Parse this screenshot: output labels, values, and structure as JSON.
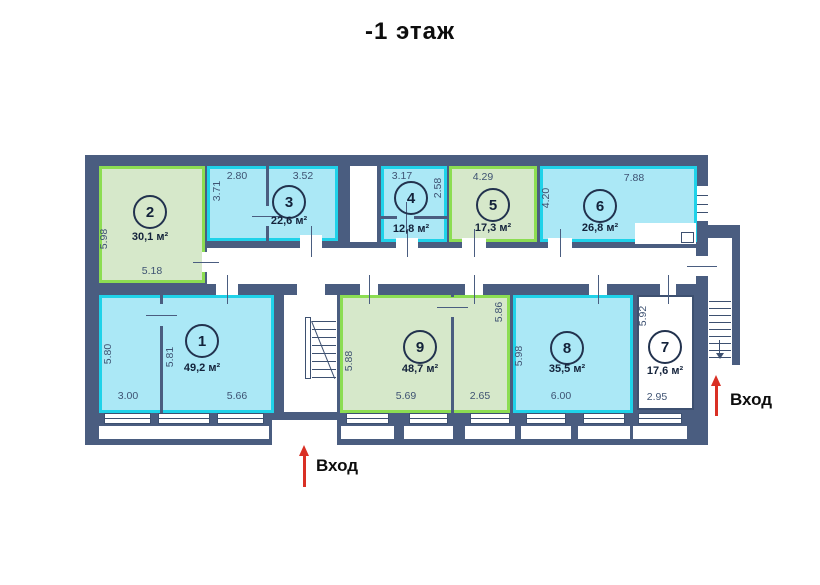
{
  "title": "-1 этаж",
  "colors": {
    "wall": "#4a5d80",
    "green_fill": "#d6e8ca",
    "green_border": "#8cdd52",
    "cyan_fill": "#abe8f6",
    "cyan_border": "#1fd2e9",
    "white_fill": "#ffffff",
    "white_border": "#3d5070",
    "dim_text": "#3e5272",
    "label_text": "#13223a",
    "arrow_red": "#d93025"
  },
  "plan": {
    "walls": [
      {
        "name": "main-building-slab",
        "x": 85,
        "y": 155,
        "w": 623,
        "h": 290
      },
      {
        "name": "exterior-stair-annex-slab",
        "x": 695,
        "y": 225,
        "w": 45,
        "h": 140
      }
    ],
    "rooms": [
      {
        "number": "1",
        "area": "49,2 м²",
        "color": "cyan",
        "x": 99,
        "y": 295,
        "w": 175,
        "h": 118,
        "cx": 202,
        "cy": 341,
        "ay": 368
      },
      {
        "number": "2",
        "area": "30,1 м²",
        "color": "green",
        "x": 99,
        "y": 166,
        "w": 106,
        "h": 117,
        "cx": 150,
        "cy": 212,
        "ay": 237
      },
      {
        "number": "3",
        "area": "22,6 м²",
        "color": "cyan",
        "x": 207,
        "y": 166,
        "w": 131,
        "h": 75,
        "cx": 289,
        "cy": 202,
        "ay": 221
      },
      {
        "number": "4",
        "area": "12,8 м²",
        "color": "cyan",
        "x": 381,
        "y": 166,
        "w": 66,
        "h": 76,
        "cx": 411,
        "cy": 198,
        "ay": 229
      },
      {
        "number": "5",
        "area": "17,3 м²",
        "color": "green",
        "x": 449,
        "y": 166,
        "w": 88,
        "h": 76,
        "cx": 493,
        "cy": 205,
        "ay": 228
      },
      {
        "number": "6",
        "area": "26,8 м²",
        "color": "cyan",
        "x": 540,
        "y": 166,
        "w": 157,
        "h": 76,
        "cx": 600,
        "cy": 206,
        "ay": 228
      },
      {
        "number": "7",
        "area": "17,6 м²",
        "color": "white",
        "x": 637,
        "y": 295,
        "w": 57,
        "h": 115,
        "cx": 665,
        "cy": 347,
        "ay": 371
      },
      {
        "number": "8",
        "area": "35,5 м²",
        "color": "cyan",
        "x": 513,
        "y": 295,
        "w": 120,
        "h": 118,
        "cx": 567,
        "cy": 348,
        "ay": 369
      },
      {
        "number": "9",
        "area": "48,7 м²",
        "color": "green",
        "x": 340,
        "y": 295,
        "w": 170,
        "h": 118,
        "cx": 420,
        "cy": 347,
        "ay": 369
      }
    ],
    "white_areas": [
      {
        "name": "corridor",
        "x": 207,
        "y": 248,
        "w": 489,
        "h": 36
      },
      {
        "name": "corridor-notch",
        "x": 635,
        "y": 223,
        "w": 61,
        "h": 21
      },
      {
        "name": "shaft",
        "x": 350,
        "y": 166,
        "w": 27,
        "h": 76
      },
      {
        "name": "stairwell",
        "x": 284,
        "y": 295,
        "w": 53,
        "h": 117
      },
      {
        "name": "annex-interior",
        "x": 708,
        "y": 238,
        "w": 24,
        "h": 127
      },
      {
        "name": "entrance-opening",
        "x": 272,
        "y": 420,
        "w": 65,
        "h": 26
      }
    ],
    "boxes": [
      {
        "name": "duct-box",
        "x": 681,
        "y": 232,
        "w": 13,
        "h": 11
      }
    ],
    "partitions": [
      {
        "name": "room3-partition",
        "dir": "v",
        "x": 266,
        "y": 166,
        "len": 75,
        "gap": [
          206,
          226
        ]
      },
      {
        "name": "room4-partition",
        "dir": "h",
        "x": 381,
        "y": 216,
        "len": 66,
        "gap": [
          397,
          414
        ]
      },
      {
        "name": "room1-partition",
        "dir": "v",
        "x": 160,
        "y": 295,
        "len": 118,
        "gap": [
          304,
          326
        ]
      },
      {
        "name": "room9-partition",
        "dir": "v",
        "x": 451,
        "y": 295,
        "len": 118,
        "gap": [
          297,
          317
        ]
      }
    ],
    "doors": [
      {
        "name": "door-room3-corridor",
        "x": 300,
        "y": 235,
        "w": 22,
        "h": 13,
        "tick": "v"
      },
      {
        "name": "door-room4-corridor",
        "x": 396,
        "y": 238,
        "w": 22,
        "h": 10,
        "tick": "v"
      },
      {
        "name": "door-room5-corridor",
        "x": 462,
        "y": 238,
        "w": 24,
        "h": 10,
        "tick": "v"
      },
      {
        "name": "door-room6-corridor",
        "x": 548,
        "y": 238,
        "w": 24,
        "h": 10,
        "tick": "v"
      },
      {
        "name": "door-room2-corridor",
        "x": 202,
        "y": 252,
        "w": 8,
        "h": 20,
        "tick": "h"
      },
      {
        "name": "door-corridor-room1",
        "x": 216,
        "y": 284,
        "w": 22,
        "h": 11,
        "tick": "v"
      },
      {
        "name": "door-corridor-stairwell",
        "x": 297,
        "y": 284,
        "w": 28,
        "h": 11,
        "tick": ""
      },
      {
        "name": "door-corridor-room9a",
        "x": 360,
        "y": 284,
        "w": 18,
        "h": 11,
        "tick": "v"
      },
      {
        "name": "door-corridor-room9b",
        "x": 465,
        "y": 284,
        "w": 18,
        "h": 11,
        "tick": "v"
      },
      {
        "name": "door-corridor-room8",
        "x": 589,
        "y": 284,
        "w": 18,
        "h": 11,
        "tick": "v"
      },
      {
        "name": "door-corridor-room7",
        "x": 660,
        "y": 284,
        "w": 16,
        "h": 11,
        "tick": "v"
      },
      {
        "name": "door-corridor-annex",
        "x": 696,
        "y": 256,
        "w": 12,
        "h": 20,
        "tick": "h"
      }
    ],
    "windows_bottom": [
      {
        "x": 104,
        "w": 47
      },
      {
        "x": 158,
        "w": 52
      },
      {
        "x": 217,
        "w": 47
      },
      {
        "x": 346,
        "w": 43
      },
      {
        "x": 409,
        "w": 39
      },
      {
        "x": 470,
        "w": 40
      },
      {
        "x": 526,
        "w": 40
      },
      {
        "x": 583,
        "w": 42
      },
      {
        "x": 638,
        "w": 44
      }
    ],
    "windows_side": [
      {
        "x": 697,
        "y": 186,
        "w": 11,
        "h": 35
      }
    ],
    "dimensions": [
      {
        "text": "5.98",
        "x": 104,
        "y": 239,
        "vertical": true
      },
      {
        "text": "5.18",
        "x": 152,
        "y": 271
      },
      {
        "text": "2.80",
        "x": 237,
        "y": 176
      },
      {
        "text": "3.71",
        "x": 217,
        "y": 191,
        "vertical": true
      },
      {
        "text": "3.52",
        "x": 303,
        "y": 176
      },
      {
        "text": "3.17",
        "x": 402,
        "y": 176
      },
      {
        "text": "2.58",
        "x": 438,
        "y": 188,
        "vertical": true
      },
      {
        "text": "4.29",
        "x": 483,
        "y": 177
      },
      {
        "text": "4.20",
        "x": 546,
        "y": 198,
        "vertical": true
      },
      {
        "text": "7.88",
        "x": 634,
        "y": 178
      },
      {
        "text": "5.80",
        "x": 108,
        "y": 354,
        "vertical": true
      },
      {
        "text": "5.81",
        "x": 170,
        "y": 357,
        "vertical": true
      },
      {
        "text": "3.00",
        "x": 128,
        "y": 396
      },
      {
        "text": "5.66",
        "x": 237,
        "y": 396
      },
      {
        "text": "5.88",
        "x": 349,
        "y": 361,
        "vertical": true
      },
      {
        "text": "5.86",
        "x": 499,
        "y": 312,
        "vertical": true
      },
      {
        "text": "5.69",
        "x": 406,
        "y": 396
      },
      {
        "text": "2.65",
        "x": 480,
        "y": 396
      },
      {
        "text": "5.98",
        "x": 519,
        "y": 356,
        "vertical": true
      },
      {
        "text": "6.00",
        "x": 561,
        "y": 396
      },
      {
        "text": "5.92",
        "x": 643,
        "y": 316,
        "vertical": true
      },
      {
        "text": "2.95",
        "x": 657,
        "y": 397
      }
    ],
    "stairs": {
      "mid": {
        "rail": {
          "x": 305,
          "y": 317,
          "w": 6,
          "h": 62
        },
        "treads": {
          "x": 312,
          "w": 24,
          "y0": 321,
          "dy": 8,
          "n": 8
        },
        "diag": {
          "x": 312,
          "y": 321,
          "len": 62,
          "angle": 68
        }
      },
      "annex": {
        "treads": {
          "x": 709,
          "w": 22,
          "y0": 301,
          "dy": 7,
          "n": 9
        },
        "down_arrow": {
          "x": 719,
          "y": 340,
          "h": 13
        }
      }
    },
    "entrances": [
      {
        "label": "Вход",
        "arrow_x": 303,
        "arrow_y": 445,
        "arrow_h": 42,
        "label_x": 316,
        "label_y": 456
      },
      {
        "label": "Вход",
        "arrow_x": 715,
        "arrow_y": 375,
        "arrow_h": 41,
        "label_x": 730,
        "label_y": 390
      }
    ]
  }
}
